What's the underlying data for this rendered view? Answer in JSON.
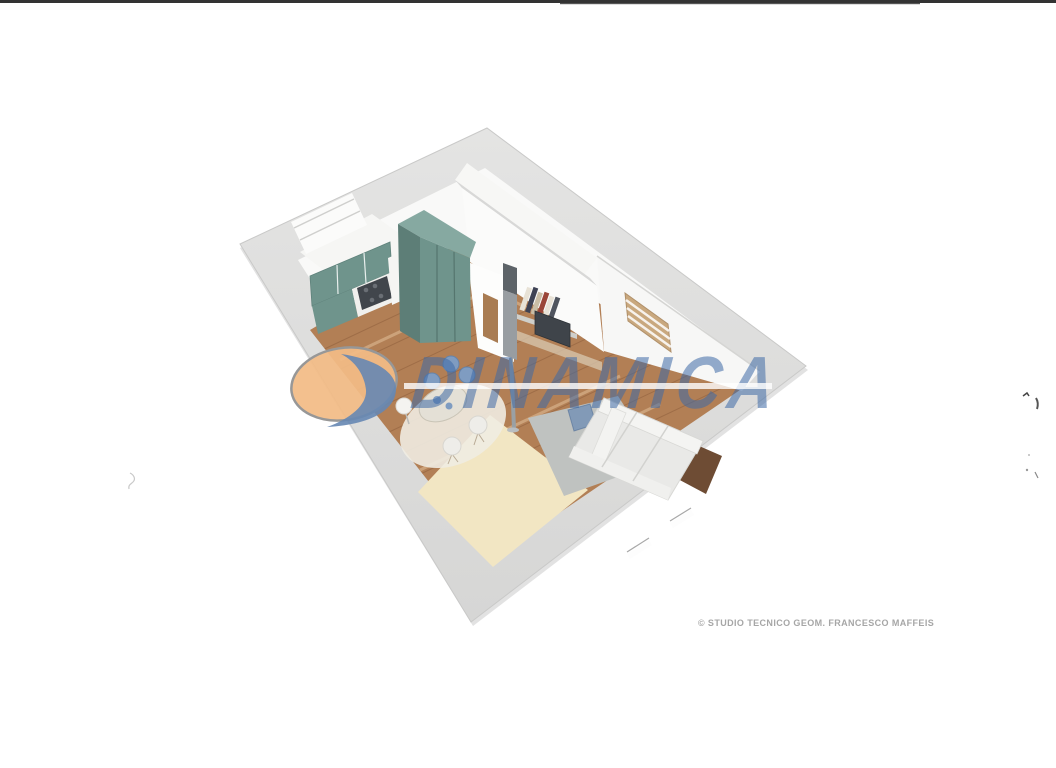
{
  "watermark": {
    "brand": "DINAMICA",
    "logo_icon": "dinamica-ellipse-swoosh-logo",
    "text_color": "#3e6aa5",
    "ellipse_color": "#f2bb85",
    "swoosh_color": "#6687b3"
  },
  "credit": {
    "text": "© STUDIO TECNICO GEOM. FRANCESCO MAFFEIS"
  },
  "floorplan": {
    "type": "3d-axonometric-apartment-render",
    "colors": {
      "slab_gray": "#dedede",
      "wall_white": "#f9f9f8",
      "wood_floor": "#b27f55",
      "cabinet_teal": "#6f948c",
      "rug_beige": "#f2e6c3",
      "rug_gray": "#bfc2c0",
      "sofa_white": "#e9e9e7",
      "accent_blue": "#7f9cc1",
      "tv_dark": "#3f444a",
      "blinds_wood": "#c9a87e"
    }
  }
}
